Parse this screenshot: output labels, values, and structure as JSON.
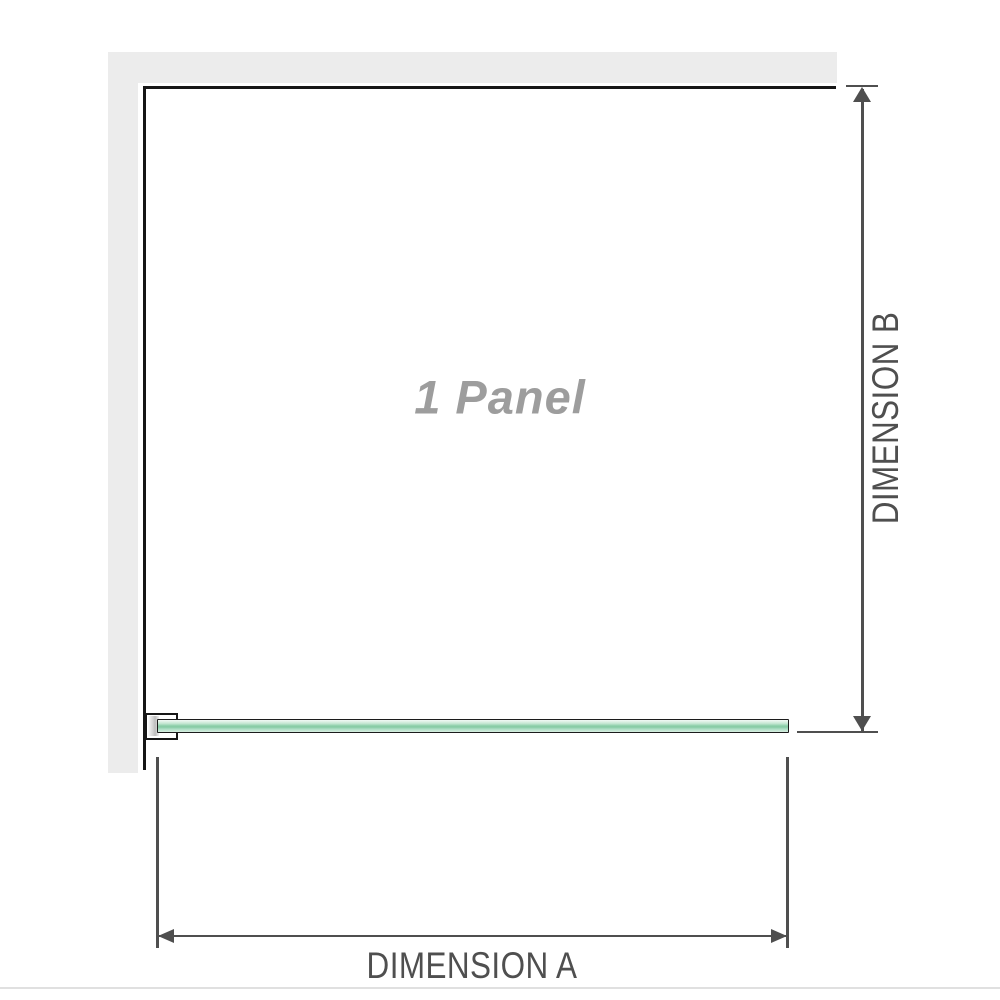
{
  "diagram": {
    "title": "1 Panel",
    "dimensions": {
      "a_label": "DIMENSION A",
      "b_label": "DIMENSION B"
    },
    "colors": {
      "wall_gray": "#ececec",
      "outline_black": "#161616",
      "glass_green_mid": "#8fd0ab",
      "glass_green_light": "#d3edde",
      "dimension_gray": "#4f4f4f",
      "panel_label_gray": "#9d9d9d",
      "divider_gray": "#e0e0e0"
    }
  }
}
